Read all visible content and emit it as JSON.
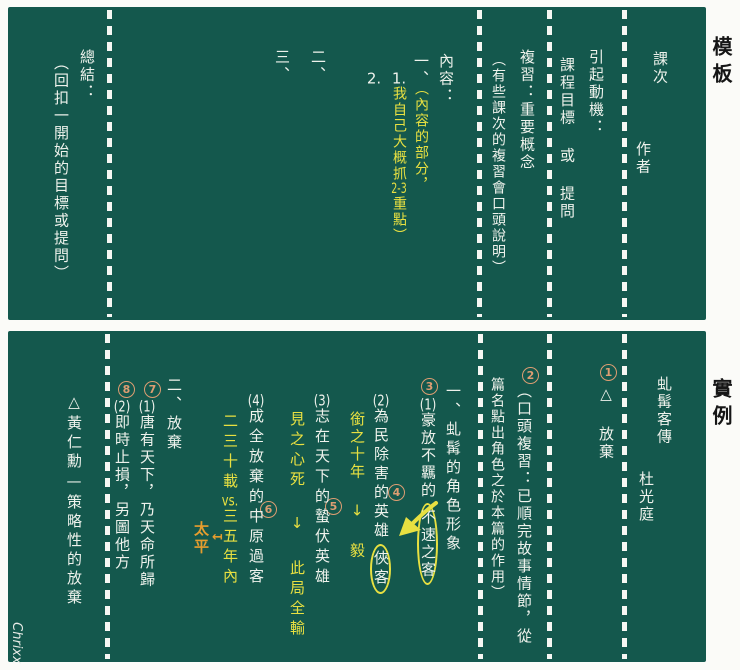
{
  "page": {
    "template_label": "模板",
    "example_label": "實例",
    "signature": "Chrixx"
  },
  "colors": {
    "board_green": "#14584d",
    "chalk_white": "#eef2ec",
    "chalk_yellow": "#e8e041",
    "circled_number_salmon": "#dd9d72",
    "annotation_orange": "#e59d2e"
  },
  "template_panel": {
    "lesson": "課次",
    "author": "作者",
    "motivation_heading": "引起動機：",
    "motivation_body": "課程目標 或 提問",
    "review_heading": "複習：重要概念",
    "review_note": "（有些課次的複習會口頭說明）",
    "content_heading": "內容：",
    "content_item1": "一、",
    "content_note1": "（內容的部分，",
    "content_sub1": "1.",
    "content_note2a": "我自己大概抓",
    "content_note2b": "2-3",
    "content_note2c": "重點）",
    "content_sub2": "2.",
    "content_item2": "二、",
    "content_item3": "三、",
    "summary_heading": "總結：",
    "summary_body": "（回扣一開始的目標或提問）"
  },
  "example_panel": {
    "title": "虬髯客傳",
    "author": "杜光庭",
    "step1": {
      "num": "1",
      "text": "△ 放棄"
    },
    "step2": {
      "num": "2",
      "line1": "（口頭複習：已順完故事情節，從",
      "line2": "篇名點出角色之於本篇的作用）"
    },
    "section1_heading": "一、虬髯的角色形象",
    "point1": {
      "num": "3",
      "label": "(1)",
      "text": "豪放不羈的",
      "circled": "不速之客"
    },
    "point2": {
      "num": "4",
      "label": "(2)",
      "text": "為民除害的英雄",
      "circled": "俠客",
      "note": "銜之十年 ↓ 毅"
    },
    "point3": {
      "num": "5",
      "label": "(3)",
      "text": "志在天下的蟄伏英雄",
      "note": "見之心死 ↓ 此局全輸"
    },
    "point4": {
      "num": "6",
      "label": "(4)",
      "text": "成全放棄的中原過客",
      "note_a": "二三十載",
      "note_b": "vs.",
      "note_c": "三五年內",
      "annotation": "太平",
      "annotation_arrow": "↤"
    },
    "section2_heading": "二、放棄",
    "point5": {
      "num": "7",
      "label": "(1)",
      "text": "唐有天下，乃天命所歸"
    },
    "point6": {
      "num": "8",
      "label": "(2)",
      "text": "即時止損，另圖他方"
    },
    "aside": "△黃仁勳—策略性的放棄"
  }
}
